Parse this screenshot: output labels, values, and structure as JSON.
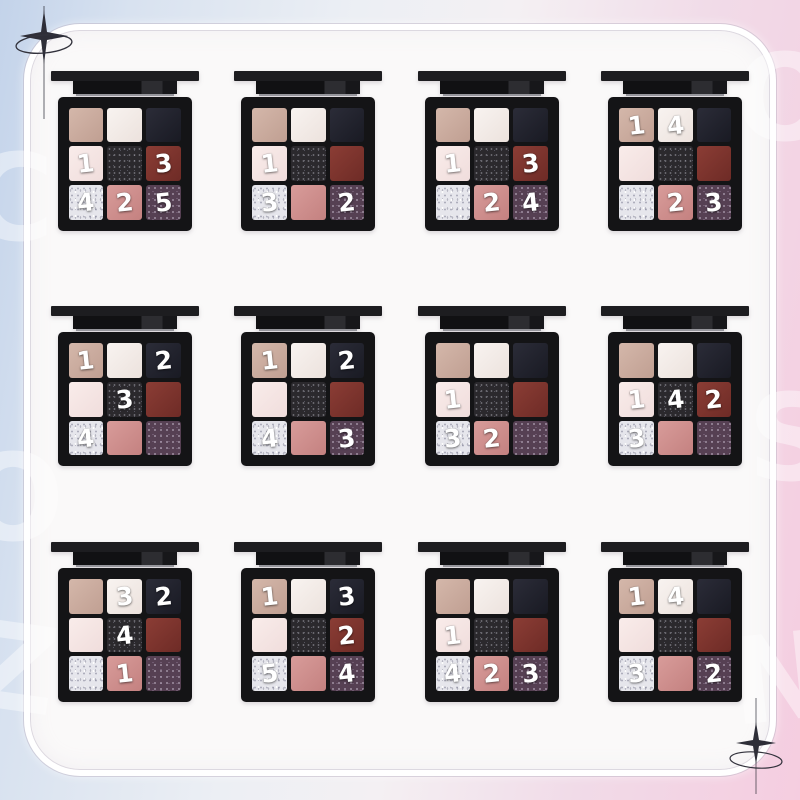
{
  "meta": {
    "description": "Grid of twelve black nine-pan eyeshadow palettes with white numbered application steps on selected pans, over a pastel blue-to-pink gradient with a glassy rounded frame"
  },
  "background": {
    "gradient_left": "#c3d3ea",
    "gradient_right": "#f5cde0",
    "panel": "#faf9f9",
    "case_color": "#141416",
    "number_color": "#ffffff"
  },
  "decorations": {
    "sparkles": [
      "sparkle-top-left",
      "sparkle-bottom-right"
    ],
    "watermark_letters": [
      "C",
      "O",
      "Z",
      "O",
      "S",
      "N"
    ]
  },
  "shades": {
    "beige": "#c9ab9e",
    "cream": "#f2ece8",
    "black": "#20222c",
    "pale-pink": "#f5e6e5",
    "charcoal-glitter": "#2b292d",
    "brick-red": "#7b332d",
    "silver-glitter": "#e4e4ea",
    "rose": "#ce8d8c",
    "purple-glitter": "#584254"
  },
  "shade_grid": [
    [
      "beige",
      "cream",
      "black"
    ],
    [
      "pale-pink",
      "charcoal-glitter",
      "brick-red"
    ],
    [
      "silver-glitter",
      "rose",
      "purple-glitter"
    ]
  ],
  "palettes": [
    {
      "numbers": [
        "",
        "",
        "",
        "1",
        "",
        "3",
        "4",
        "2",
        "5"
      ]
    },
    {
      "numbers": [
        "",
        "",
        "",
        "1",
        "",
        "",
        "3",
        "",
        "2"
      ]
    },
    {
      "numbers": [
        "",
        "",
        "",
        "1",
        "",
        "3",
        "",
        "2",
        "4"
      ]
    },
    {
      "numbers": [
        "1",
        "4",
        "",
        "",
        "",
        "",
        "",
        "2",
        "3"
      ]
    },
    {
      "numbers": [
        "1",
        "",
        "2",
        "",
        "3",
        "",
        "4",
        "",
        ""
      ]
    },
    {
      "numbers": [
        "1",
        "",
        "2",
        "",
        "",
        "",
        "4",
        "",
        "3"
      ]
    },
    {
      "numbers": [
        "",
        "",
        "",
        "1",
        "",
        "",
        "3",
        "2",
        ""
      ]
    },
    {
      "numbers": [
        "",
        "",
        "",
        "1",
        "4",
        "2",
        "3",
        "",
        ""
      ]
    },
    {
      "numbers": [
        "",
        "3",
        "2",
        "",
        "4",
        "",
        "",
        "1",
        ""
      ]
    },
    {
      "numbers": [
        "1",
        "",
        "3",
        "",
        "",
        "2",
        "5",
        "",
        "4"
      ]
    },
    {
      "numbers": [
        "",
        "",
        "",
        "1",
        "",
        "",
        "4",
        "2",
        "3"
      ]
    },
    {
      "numbers": [
        "1",
        "4",
        "",
        "",
        "",
        "",
        "3",
        "",
        "2"
      ]
    }
  ]
}
